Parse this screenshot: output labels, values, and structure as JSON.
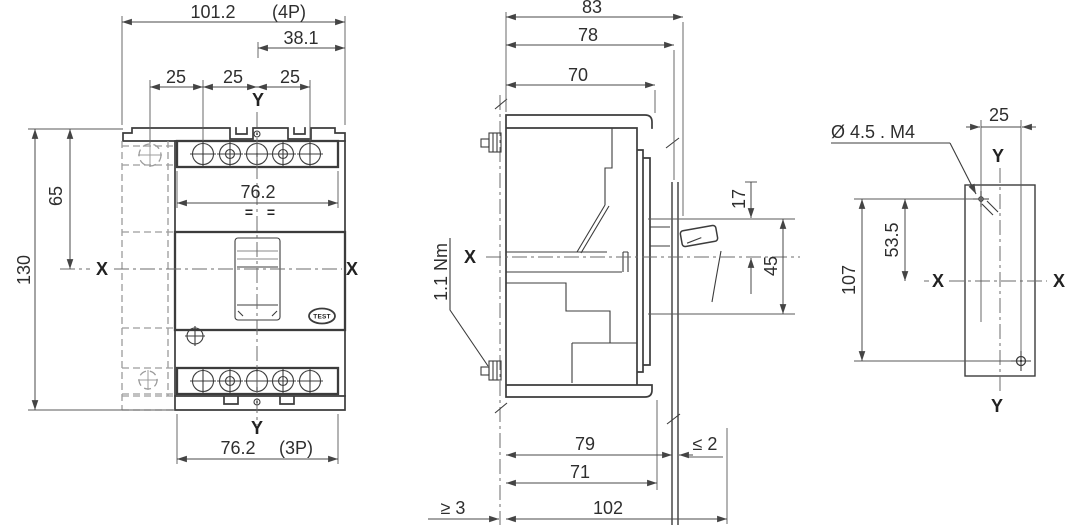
{
  "axes": {
    "x": "X",
    "y": "Y"
  },
  "front_view": {
    "dims": {
      "overall_width": "101.2",
      "overall_width_note": "(4P)",
      "handle_offset": "38.1",
      "pitch_1": "25",
      "pitch_2": "25",
      "pitch_3": "25",
      "center_height": "65",
      "overall_height": "130",
      "terminal_width": "76.2",
      "terminal_width_bottom": "76.2",
      "bottom_note": "(3P)"
    },
    "equal_mark": "=",
    "test_label": "TEST"
  },
  "side_view": {
    "dims": {
      "depth_overall": "83",
      "depth_to_panel": "78",
      "depth_to_bezel": "70",
      "handle_to_center": "17",
      "cutout_height": "45",
      "behind_panel": "79",
      "bezel_depth": "71",
      "min_clearance": "≥ 3",
      "total_depth": "102",
      "max_panel_thickness": "≤ 2"
    },
    "torque_label": "1.1 Nm"
  },
  "drilling_plan": {
    "hole_note": "Ø 4.5  . M4",
    "dims": {
      "hole_offset": "25",
      "hole_to_center": "53.5",
      "hole_spacing": "107"
    }
  }
}
